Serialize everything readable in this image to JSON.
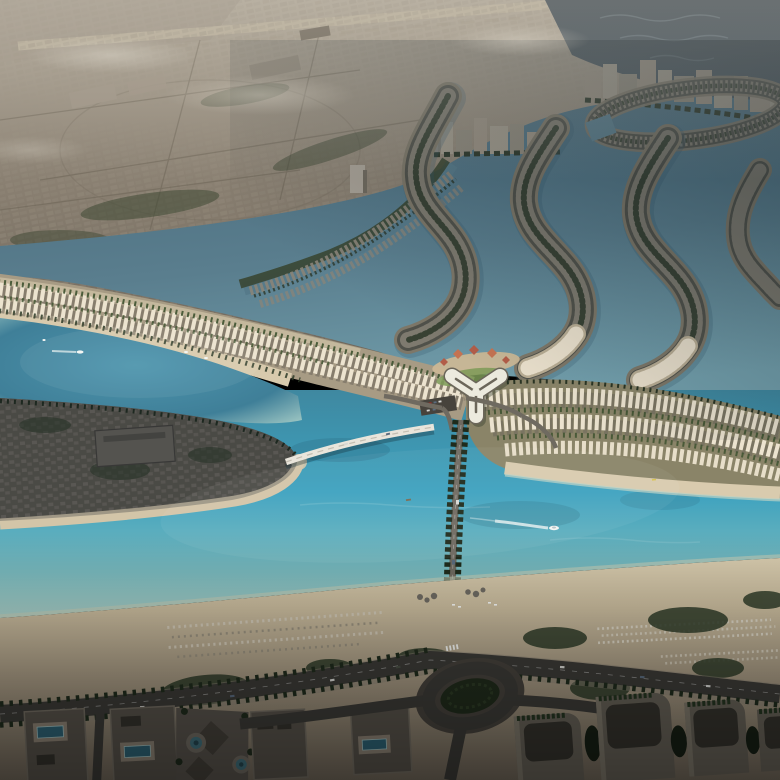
{
  "colors": {
    "sky-haze": "#a89f90",
    "city-light": "#9b9183",
    "city-base": "#877d6f",
    "city-dark": "#6e665a",
    "city-block": "#958c7d",
    "runway": "#b3a995",
    "fog": "#d6d0c3",
    "sea-dark": "#39444c",
    "sea-mid": "#4d5b64",
    "wave": "#6b7a82",
    "lagoon-deep": "#47687a",
    "lagoon": "#5a7e8e",
    "lagoon-light": "#73a0ad",
    "canal": "#567a8a",
    "canal-veg": "#37432e",
    "island-sand": "#7d7768",
    "island-dark": "#50514a",
    "island-villa": "#8a8478",
    "island-veg": "#2c3729",
    "turq-core": "#4e95ad",
    "turq-deep": "#3f7f98",
    "turq-rim": "#a9cfc8",
    "strip-land": "#a79b84",
    "strip-beach": "#d8caad",
    "strip-sand-top": "#c4b89d",
    "villa-cream": "#ece3cf",
    "villa-shadow": "#6f695e",
    "veg-green": "#3e5230",
    "lawn": "#7c9a57",
    "sail-red": "#b25d48",
    "sail-red2": "#c47352",
    "roof-white": "#eceade",
    "roof-ridge": "#6b665a",
    "club-shadow": "#232d22",
    "club-sand": "#cbb795",
    "parking": "#47433c",
    "car-light": "#d8d8d4",
    "car-red": "#8a2f2a",
    "channel-deep": "#3f88a0",
    "channel-bright": "#3da2bf",
    "channel-light": "#79b9bd",
    "shallow": "#a8cdc5",
    "reef": "#2c6b80",
    "sand-bright": "#d7cbae",
    "sand-mid": "#c9bb9d",
    "sand-dim": "#a2957f",
    "sand-shadow": "#6e6558",
    "bush": "#2e3b28",
    "umbrella": "#cfc7b5",
    "umbrella2": "#98907e",
    "sunbed": "#d9d3c3",
    "rock": "#6e6a62",
    "road": "#3b3a36",
    "road-edge": "#8a8274",
    "tree-dark": "#1f2b1c",
    "bridge-white": "#e9e5db",
    "bridge-shadow": "#14303c",
    "cswy-road": "#6f6a60",
    "leftisl-base": "#5e5a4f",
    "grid-villa": "#767066",
    "leftisl-shade": "#18222a",
    "bigroof": "#6b675d",
    "bigroof-line": "#45423c",
    "bldg-face": "#565149",
    "bldg-face2": "#645f55",
    "bldg-roof": "#34322c",
    "bldg-parapet": "#716b60",
    "pool": "#2d6274",
    "pool-rim": "#9fc0c0",
    "deck": "#8b8173",
    "plaza": "#57524b",
    "plaza-dark": "#444039",
    "medal-ring": "#6e6960",
    "medal-teal": "#3f6e7a",
    "medal-deep": "#24454f",
    "tower-face": "#645f55",
    "tower-hi": "#7b7568",
    "tower-roof": "#34322c",
    "roofgarden": "#243420",
    "tree-blob": "#161f14",
    "rnd-green": "#202b1b",
    "rnd-apron": "#45413b",
    "white": "#f4f6f3",
    "steel": "#5a6b7e",
    "wake": "#eef4f2",
    "hull-dot": "#b7c3c6",
    "ne-shadow": "#131f26",
    "haze-white": "#ded8cb"
  }
}
